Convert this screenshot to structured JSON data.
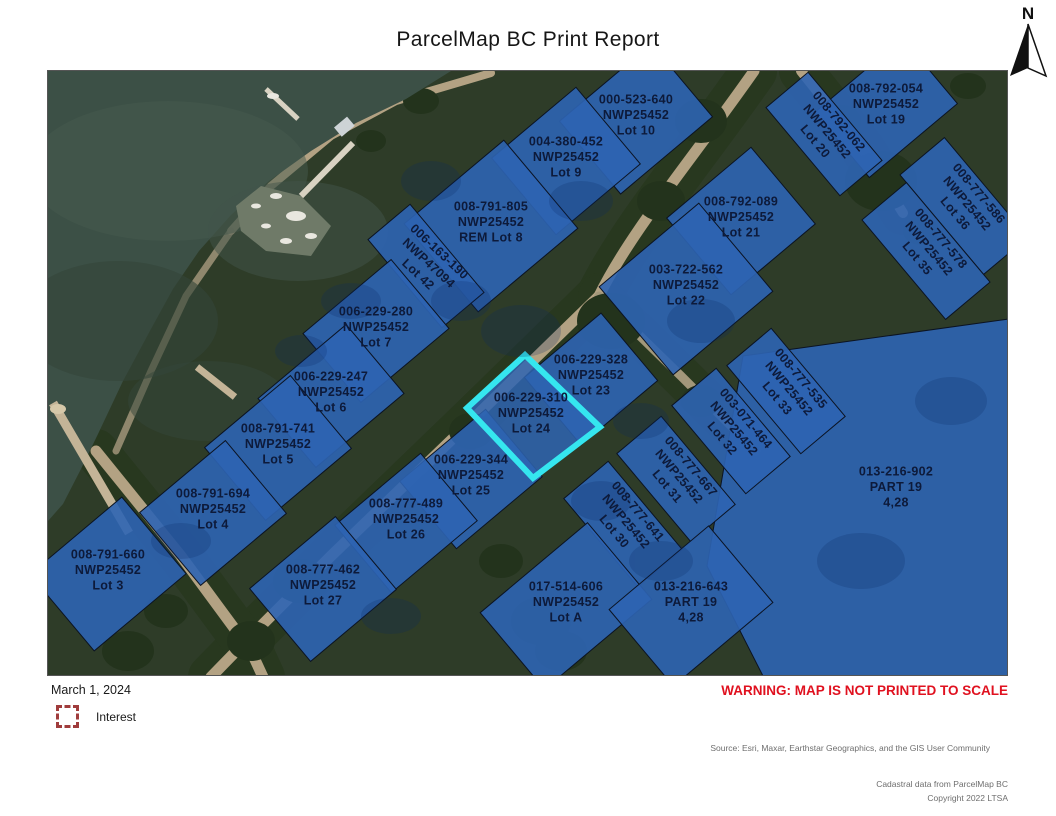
{
  "title": "ParcelMap BC Print Report",
  "north_label": "N",
  "footer": {
    "date": "March 1, 2024",
    "legend_label": "Interest",
    "warning": "WARNING: MAP IS NOT PRINTED TO SCALE",
    "source": "Source: Esri, Maxar, Earthstar Geographics, and the GIS User Community",
    "credit_line1": "Cadastral data from ParcelMap BC",
    "credit_line2": "Copyright 2022 LTSA"
  },
  "colors": {
    "parcel_fill": "#2e64b2",
    "parcel_line": "#0b1322",
    "highlight": "#35e6ef",
    "label_color": "#0d1a3a",
    "warning_red": "#e0111f",
    "legend_red": "#a03c3c",
    "water": "#3c5046",
    "land": "#2e3c28",
    "trees": "#23331c",
    "road": "#b3a283"
  },
  "map": {
    "parcels": [
      {
        "id": "013-216-902",
        "lines": [
          "013-216-902",
          "PART 19",
          "4,28"
        ],
        "cx": 848,
        "cy": 420,
        "rot": 0,
        "poly": "695,285 961,248 961,605 715,605 659,495"
      },
      {
        "id": "000-523-640",
        "lines": [
          "000-523-640",
          "NWP25452",
          "Lot 10"
        ],
        "cx": 588,
        "cy": 48,
        "w": 120,
        "h": 95,
        "rot": 0
      },
      {
        "id": "004-380-452",
        "lines": [
          "004-380-452",
          "NWP25452",
          "Lot 9"
        ],
        "cx": 518,
        "cy": 90,
        "w": 110,
        "h": 100,
        "rot": 0
      },
      {
        "id": "008-791-805",
        "lines": [
          "008-791-805",
          "NWP25452",
          "REM Lot 8"
        ],
        "cx": 443,
        "cy": 155,
        "w": 130,
        "h": 115,
        "rot": 0
      },
      {
        "id": "006-163-190",
        "lines": [
          "006-163-190",
          "NWP47094",
          "Lot 42"
        ],
        "cx": 378,
        "cy": 195,
        "w": 55,
        "h": 115,
        "rot": 43
      },
      {
        "id": "008-792-054",
        "lines": [
          "008-792-054",
          "NWP25452",
          "Lot 19"
        ],
        "cx": 838,
        "cy": 37,
        "w": 115,
        "h": 85,
        "rot": 0
      },
      {
        "id": "008-792-062",
        "lines": [
          "008-792-062",
          "NWP25452",
          "Lot 20"
        ],
        "cx": 776,
        "cy": 63,
        "w": 55,
        "h": 115,
        "rot": 50
      },
      {
        "id": "008-792-089",
        "lines": [
          "008-792-089",
          "NWP25452",
          "Lot 21"
        ],
        "cx": 693,
        "cy": 150,
        "w": 110,
        "h": 100,
        "rot": 0
      },
      {
        "id": "008-777-586",
        "lines": [
          "008-777-586",
          "NWP25452",
          "Lot 36"
        ],
        "cx": 916,
        "cy": 135,
        "w": 58,
        "h": 130,
        "rot": 50
      },
      {
        "id": "008-777-578",
        "lines": [
          "008-777-578",
          "NWP25452",
          "Lot 35"
        ],
        "cx": 878,
        "cy": 180,
        "w": 58,
        "h": 130,
        "rot": 50
      },
      {
        "id": "003-722-562",
        "lines": [
          "003-722-562",
          "NWP25452",
          "Lot 22"
        ],
        "cx": 638,
        "cy": 218,
        "w": 130,
        "h": 115,
        "rot": 0
      },
      {
        "id": "006-229-280",
        "lines": [
          "006-229-280",
          "NWP25452",
          "Lot 7"
        ],
        "cx": 328,
        "cy": 260,
        "w": 115,
        "h": 90,
        "rot": 0
      },
      {
        "id": "006-229-328",
        "lines": [
          "006-229-328",
          "NWP25452",
          "Lot 23"
        ],
        "cx": 543,
        "cy": 308,
        "w": 100,
        "h": 88,
        "rot": 0
      },
      {
        "id": "008-777-535",
        "lines": [
          "008-777-535",
          "NWP25452",
          "Lot 33"
        ],
        "cx": 738,
        "cy": 320,
        "w": 58,
        "h": 115,
        "rot": 50
      },
      {
        "id": "006-229-247",
        "lines": [
          "006-229-247",
          "NWP25452",
          "Lot 6"
        ],
        "cx": 283,
        "cy": 325,
        "w": 115,
        "h": 90,
        "rot": 0
      },
      {
        "id": "003-071-464",
        "lines": [
          "003-071-464",
          "NWP25452",
          "Lot 32"
        ],
        "cx": 683,
        "cy": 360,
        "w": 58,
        "h": 115,
        "rot": 50
      },
      {
        "id": "008-791-741",
        "lines": [
          "008-791-741",
          "NWP25452",
          "Lot 5"
        ],
        "cx": 230,
        "cy": 377,
        "w": 112,
        "h": 95,
        "rot": 0
      },
      {
        "id": "008-777-667",
        "lines": [
          "008-777-667",
          "NWP25452",
          "Lot 31"
        ],
        "cx": 628,
        "cy": 408,
        "w": 58,
        "h": 115,
        "rot": 50
      },
      {
        "id": "006-229-344",
        "lines": [
          "006-229-344",
          "NWP25452",
          "Lot 25"
        ],
        "cx": 423,
        "cy": 408,
        "w": 112,
        "h": 88,
        "rot": 0
      },
      {
        "id": "008-791-694",
        "lines": [
          "008-791-694",
          "NWP25452",
          "Lot 4"
        ],
        "cx": 165,
        "cy": 442,
        "w": 112,
        "h": 95,
        "rot": 0
      },
      {
        "id": "008-777-489",
        "lines": [
          "008-777-489",
          "NWP25452",
          "Lot 26"
        ],
        "cx": 358,
        "cy": 452,
        "w": 112,
        "h": 88,
        "rot": 0
      },
      {
        "id": "008-777-641",
        "lines": [
          "008-777-641",
          "NWP25452",
          "Lot 30"
        ],
        "cx": 575,
        "cy": 453,
        "w": 58,
        "h": 115,
        "rot": 50
      },
      {
        "id": "008-791-660",
        "lines": [
          "008-791-660",
          "NWP25452",
          "Lot 3"
        ],
        "cx": 60,
        "cy": 503,
        "w": 120,
        "h": 100,
        "rot": 0
      },
      {
        "id": "008-777-462",
        "lines": [
          "008-777-462",
          "NWP25452",
          "Lot 27"
        ],
        "cx": 275,
        "cy": 518,
        "w": 112,
        "h": 95,
        "rot": 0
      },
      {
        "id": "017-514-606",
        "lines": [
          "017-514-606",
          "NWP25452",
          "Lot A"
        ],
        "cx": 518,
        "cy": 535,
        "w": 140,
        "h": 100,
        "rot": 0
      },
      {
        "id": "013-216-643",
        "lines": [
          "013-216-643",
          "PART 19",
          "4,28"
        ],
        "cx": 643,
        "cy": 535,
        "w": 130,
        "h": 100,
        "rot": 0
      },
      {
        "id": "006-229-310",
        "lines": [
          "006-229-310",
          "NWP25452",
          "Lot 24"
        ],
        "cx": 483,
        "cy": 346,
        "rot": 0,
        "poly": "477,284 552,356 485,407 419,337",
        "highlighted": true
      }
    ]
  }
}
